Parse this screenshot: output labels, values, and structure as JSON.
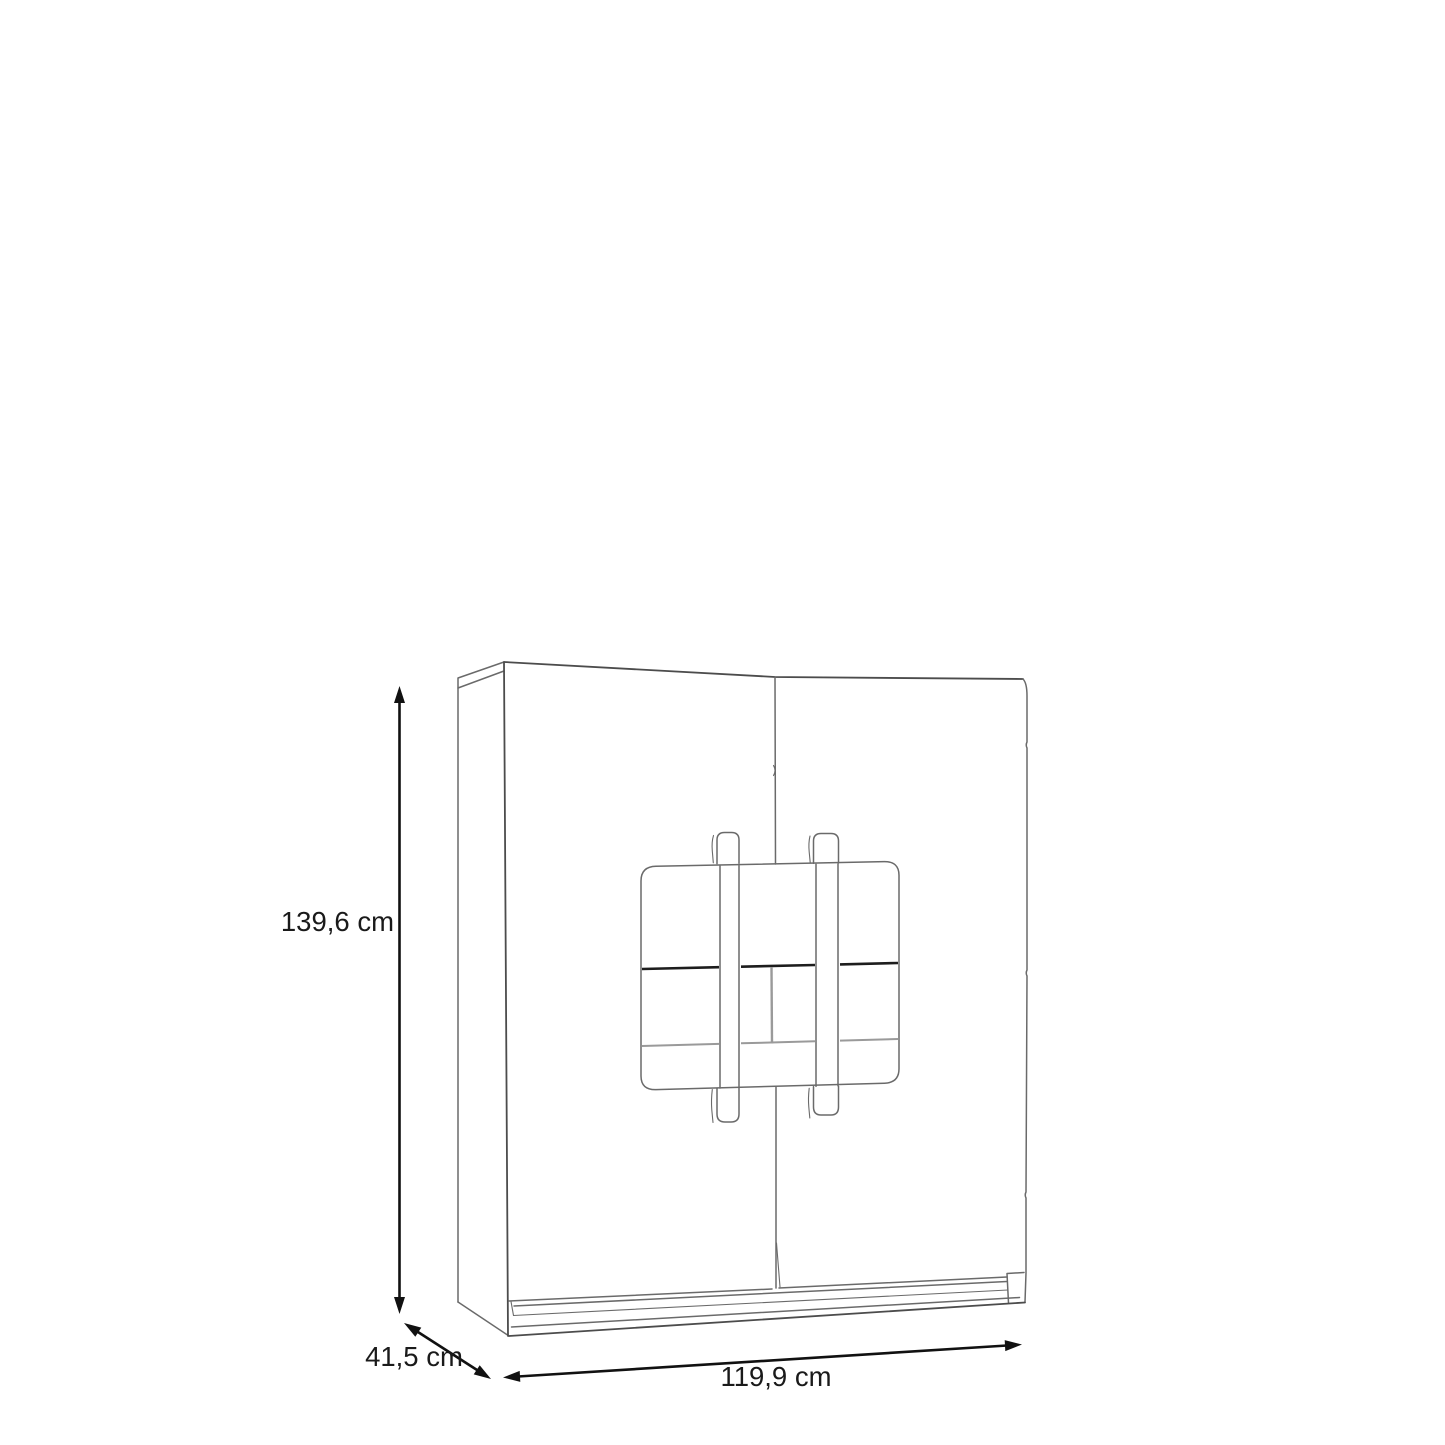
{
  "figure": {
    "type": "furniture-dimension-diagram",
    "subject": "Two-door cabinet with decorative strap-and-buckle front panel",
    "view": "front three-quarter technical line drawing",
    "background_color": "#ffffff"
  },
  "dimensions": {
    "height": {
      "label": "139,6 cm",
      "value_cm": 139.6,
      "orientation": "vertical",
      "position": "left"
    },
    "depth": {
      "label": "41,5 cm",
      "value_cm": 41.5,
      "orientation": "diagonal",
      "position": "bottom-left"
    },
    "width": {
      "label": "119,9 cm",
      "value_cm": 119.9,
      "orientation": "horizontal",
      "position": "bottom"
    }
  },
  "colors": {
    "outline": "#6a6a6a",
    "outline_dark": "#4c4c4c",
    "detail_dark": "#1d1d1d",
    "detail_light": "#9a9a9a",
    "dimension": "#111111",
    "text": "#1a1a1a"
  }
}
